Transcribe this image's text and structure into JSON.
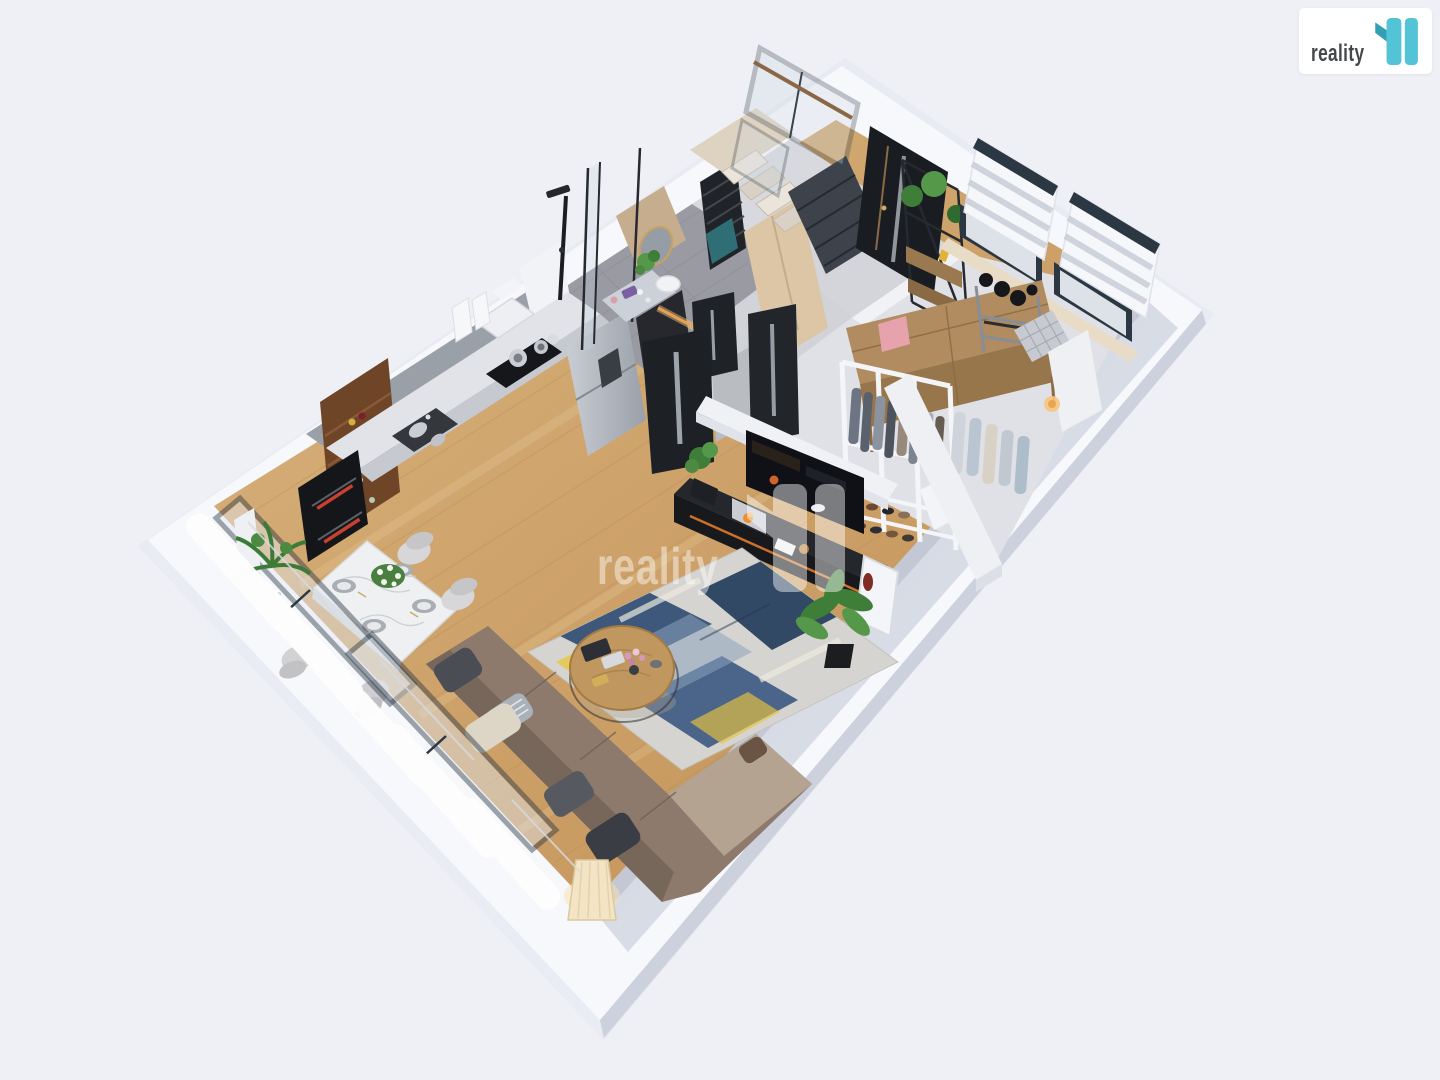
{
  "canvas": {
    "width": 1440,
    "height": 1080,
    "background": "#eff0f5",
    "description": "3D isometric dollhouse render of an apartment floor plan, viewed from above at an angle"
  },
  "logo": {
    "text": "reality",
    "mark": "11",
    "box_color": "#ffffff",
    "text_color": "#45484b",
    "accent": "#53c4d5",
    "accent_dark": "#339fb3"
  },
  "watermark": {
    "text": "reality",
    "mark": "11",
    "color": "#ffffff",
    "opacity": 0.45
  },
  "palette": {
    "bg": "#eff0f5",
    "wall-top": "#f7f8fc",
    "slab-side-left": "#e9ecf3",
    "slab-side-right": "#ccd1dd",
    "wood-light": "#d9b282",
    "wood-dark": "#c08f54",
    "bath-tile": "#9a9aa2",
    "hall-floor": "#d2d3d9",
    "ward-floor": "#e0e1e7",
    "door-dark": "#1d2125",
    "frame-slate": "#2b3844",
    "counter-top": "#e1e3e8",
    "cabinet-front": "#c6c9cf",
    "walnut": "#6f4527",
    "steel-1": "#c6cad1",
    "steel-2": "#9fa4ad",
    "marble": "#eff0f2",
    "sofa-brown": "#8d7a6c",
    "sofa-back": "#76665a",
    "chaise-beige": "#b5a392",
    "rug-base": "#d5d4d0",
    "rug-navy": "#2c4a70",
    "rug-navy-dark": "#1f3a58",
    "rug-yellow": "#e9c53f",
    "rug-blue": "#8ca3bb",
    "accent-orange": "#e07a2c",
    "plant-green": "#3f7e38",
    "plant-green-light": "#55984a",
    "oven-red": "#c8402f",
    "sill-cream": "#e9dcc6",
    "towel-teal": "#2f6e74"
  },
  "scene": {
    "rooms": [
      "open-kitchen",
      "dining-area",
      "living-room",
      "bathroom",
      "hallway",
      "entrance-vestibule",
      "staircase",
      "walk-in-wardrobe",
      "fitness-corner"
    ],
    "furniture": [
      "kitchen-counter-run",
      "gas-cooktop-with-pots",
      "kitchen-sink",
      "range-hood",
      "stainless-fridge",
      "tall-black-pantry",
      "double-wall-ovens",
      "walnut-wine-shelf",
      "marble-dining-table",
      "four-dining-chairs",
      "flower-centerpiece",
      "l-shaped-brown-sofa",
      "throw-pillows",
      "round-wood-coffee-table",
      "abstract-blue-yellow-rug",
      "pleated-floor-lamp",
      "tv-on-partition-wall",
      "black-media-sideboard-with-fireplace",
      "open-wardrobe-with-clothes",
      "shoe-shelves",
      "wood-storage-shelf",
      "pink-box",
      "dumbbell-rack",
      "checkered-mat",
      "white-desk-with-lamp",
      "glass-railing-staircase",
      "black-towel-radiator",
      "round-mirror",
      "shower-column",
      "entrance-door-dark",
      "metal-plant-shelf",
      "zebra-blind-windows",
      "curtained-window-wall",
      "potted-palms"
    ]
  }
}
